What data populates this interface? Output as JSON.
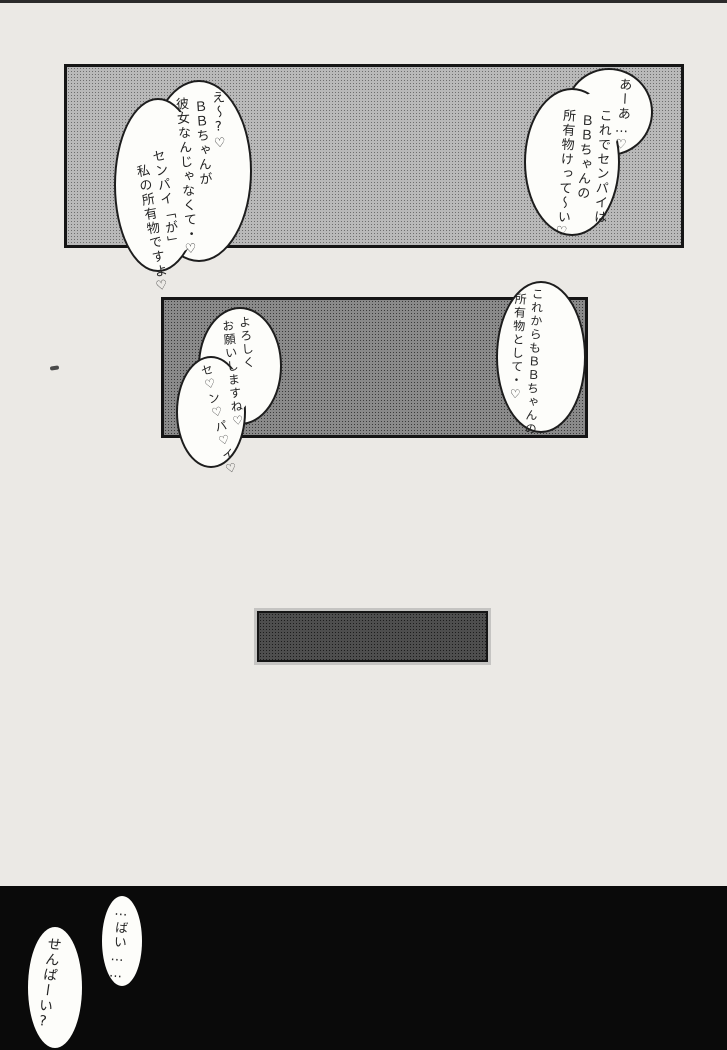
{
  "page": {
    "type": "manga-page",
    "colors": {
      "paper": "#ebe9e5",
      "panel_tone_light": "#9f9f9f",
      "panel_tone_mid": "#6f6f6f",
      "panel_tone_dark": "#3c3c3c",
      "panel_bottom_black": "#0a0a0a",
      "bubble_fill": "#fdfdfa",
      "ink": "#1d1d1d"
    }
  },
  "bubbles": {
    "top_right": {
      "speaker_note": "bubble in top panel, right side",
      "columns": [
        "あーあ…♡",
        "これでセンパイは",
        "ＢＢちゃんの",
        "所有物けって〜い♡"
      ]
    },
    "top_left": {
      "speaker_note": "bubble in top panel, left side",
      "columns": [
        "え〜?♡",
        "ＢＢちゃんが",
        "彼女なんじゃなくて・♡",
        "センパイ「が」",
        "私の所有物ですよ♡"
      ]
    },
    "mid_right": {
      "speaker_note": "bubble in middle panel, right side",
      "columns": [
        "これからもＢＢちゃんの",
        "所有物として・♡"
      ]
    },
    "mid_left": {
      "speaker_note": "bubble in middle panel, left side",
      "columns": [
        "よろしく",
        "お願いしますね♡",
        "セ♡ン♡パ♡イ♡"
      ]
    },
    "bottom_right": {
      "speaker_note": "small bubble in bottom black panel, right",
      "columns": [
        "…ばい……"
      ]
    },
    "bottom_left": {
      "speaker_note": "small bubble in bottom black panel, left",
      "columns": [
        "せんぱーい?"
      ]
    }
  }
}
